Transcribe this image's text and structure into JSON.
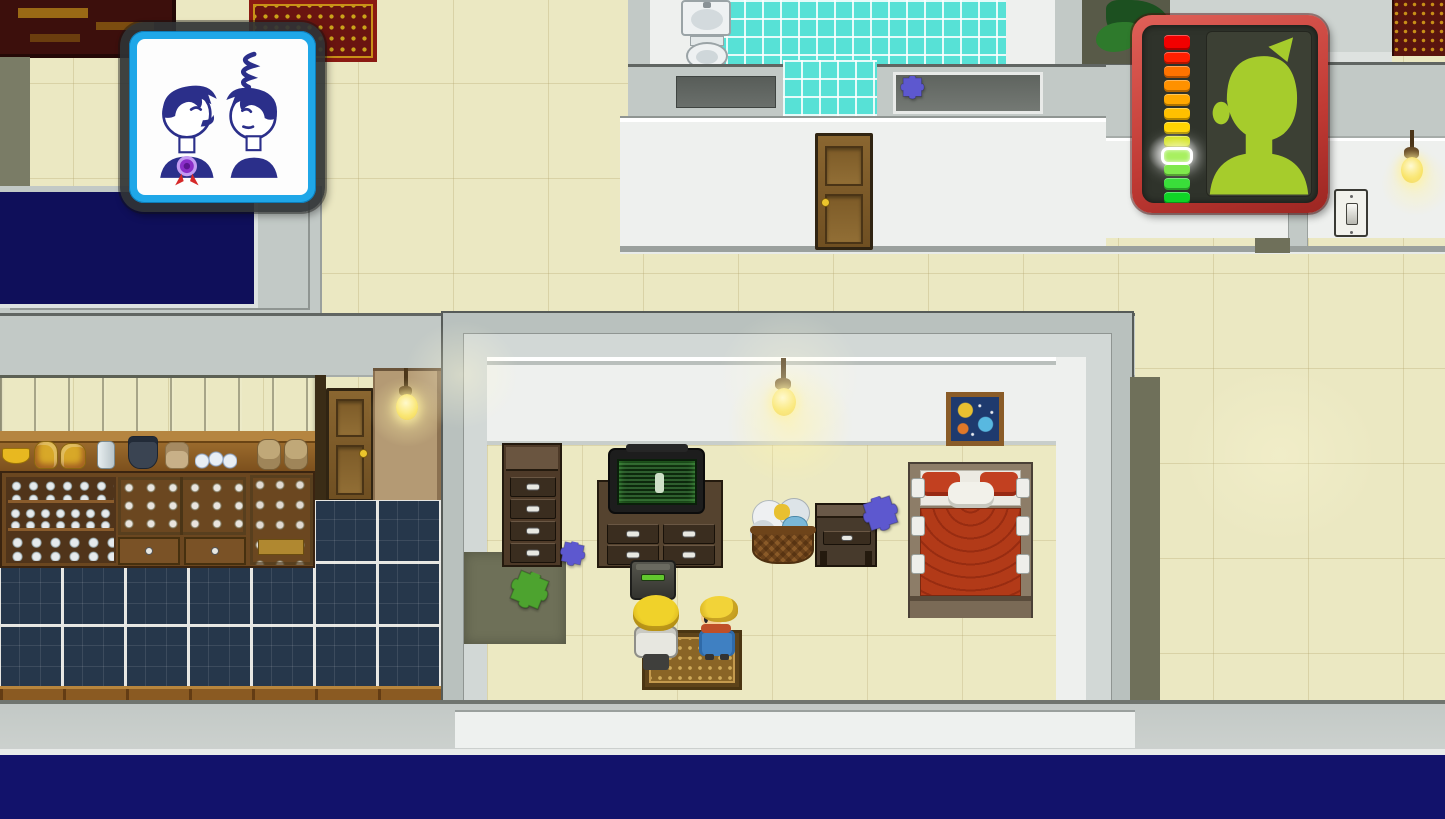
{
  "meta": {
    "genre": "top-down-pixel-rpg",
    "scene": "apartment interior with bedroom, bathroom, kitchen and hallway",
    "visible_text": "none"
  },
  "hud": {
    "relationship_popup": {
      "description": "speech-bubble icon showing two characters talking",
      "left_character": {
        "expression": "laughing",
        "accessory": "purple-medal-with-red-ribbon"
      },
      "right_character": {
        "expression": "irritated",
        "effect": "scribble-above-head"
      },
      "colors": {
        "frame": "#35383a",
        "border": "#1fa7e8",
        "background": "#fdfdfd",
        "ink": "#2b2f8a",
        "medal": "#8b2fc9",
        "ribbon": "#d62828"
      }
    },
    "mood_meter": {
      "description": "vertical mood/health gauge with character portrait",
      "colors": {
        "frame": "#c03a34",
        "background": "#2f332b",
        "portrait": "#a6cc2c",
        "portrait_bg": "#3c4034"
      },
      "current_index": 8,
      "segments": [
        {
          "color": "#f20000"
        },
        {
          "color": "#ff1f00"
        },
        {
          "color": "#ff7300"
        },
        {
          "color": "#ff9100"
        },
        {
          "color": "#ffa800"
        },
        {
          "color": "#ffc000"
        },
        {
          "color": "#ffd400"
        },
        {
          "color": "#cfe000"
        },
        {
          "color": "#a8f060",
          "current": true
        },
        {
          "color": "#7fe84c"
        },
        {
          "color": "#3ade3a"
        },
        {
          "color": "#0fd426"
        }
      ]
    }
  },
  "scene": {
    "rooms": [
      "bathroom",
      "hallway",
      "bedroom",
      "kitchen",
      "dark-room-west",
      "utility-room-east"
    ],
    "characters": [
      {
        "id": "player",
        "hair": "#f0d22a",
        "outfit": "white-jacket",
        "facing": "up",
        "x": 633,
        "y": 592
      },
      {
        "id": "npc-roommate",
        "hair": "#eccb2e",
        "outfit": "blue-shirt-red-scarf",
        "facing": "left",
        "x": 699,
        "y": 596
      }
    ],
    "collectibles": [
      {
        "kind": "puzzle-piece",
        "color": "#5d58cf",
        "x": 893,
        "y": 76,
        "size": 32,
        "rot": 0
      },
      {
        "kind": "puzzle-piece",
        "color": "#5d58cf",
        "x": 552,
        "y": 541,
        "size": 34,
        "rot": 12
      },
      {
        "kind": "puzzle-piece",
        "color": "#5d58cf",
        "x": 852,
        "y": 498,
        "size": 48,
        "rot": -18
      },
      {
        "kind": "puzzle-piece",
        "color": "#4da32f",
        "x": 498,
        "y": 570,
        "size": 52,
        "rot": 22
      }
    ],
    "furniture": [
      "double-bed-red",
      "tv",
      "tv-stand",
      "tall-dresser",
      "nightstand",
      "laundry-basket",
      "ornate-rug",
      "space-picture",
      "trash-machine",
      "kitchen-counter",
      "dish-shelves",
      "glass-cabinets",
      "bathroom-sink",
      "toilet",
      "bathroom-door",
      "kitchen-door",
      "light-switch",
      "hanging-bulbs",
      "potted-plant",
      "red-ornate-rug-top",
      "dark-bookshelf"
    ]
  }
}
